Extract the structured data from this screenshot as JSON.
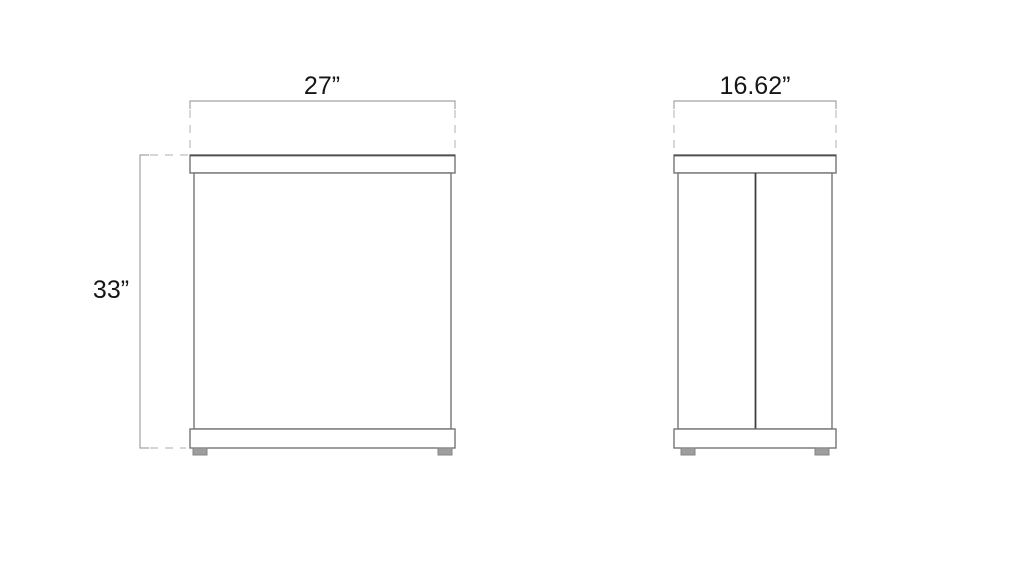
{
  "diagram": {
    "dimensions": {
      "width": {
        "label": "27”",
        "inches": 27
      },
      "height": {
        "label": "33”",
        "inches": 33
      },
      "depth": {
        "label": "16.62”",
        "inches": 16.62
      }
    },
    "colors": {
      "background": "#ffffff",
      "outline": "#757575",
      "outline_dark": "#4f4f4f",
      "dimension_line": "#a3a3a3",
      "extension_line": "#bdbdbd",
      "text": "#161616",
      "foot_fill": "#9e9e9e"
    }
  }
}
